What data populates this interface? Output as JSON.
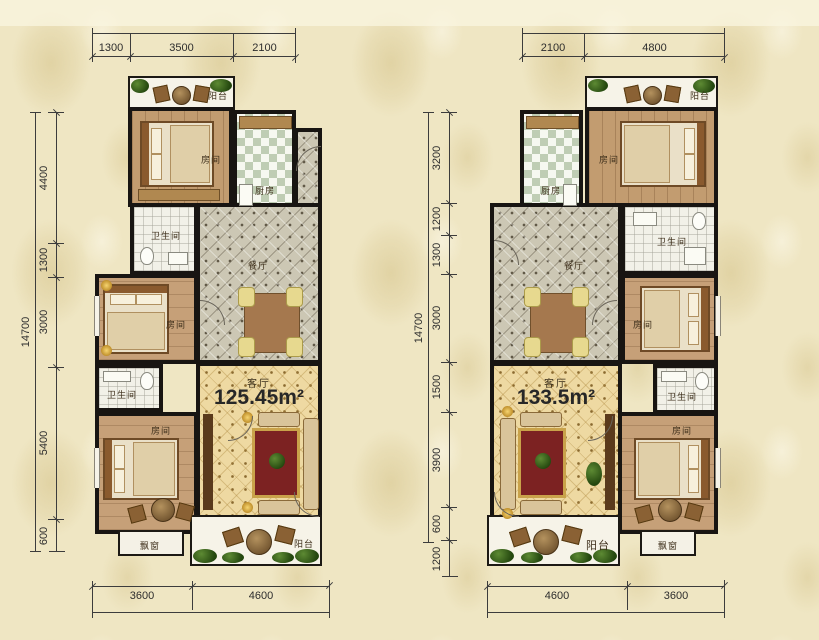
{
  "background": {
    "base": "#efe6c3",
    "pattern": "#e2d3a6"
  },
  "palette": {
    "wall": "#181512",
    "wood_floor": "#c29c70",
    "kitchen_tile": "#bfcdb4",
    "dining_tile": "#ccc7b4",
    "living_floor": "#eed9a2",
    "rug_red": "#7c2222",
    "accent_gold": "#c9a24a",
    "dimension_line": "#3c3c3c"
  },
  "labels": {
    "bedroom": "房间",
    "bathroom": "卫生间",
    "kitchen": "厨房",
    "dining": "餐厅",
    "living": "客厅",
    "balcony": "阳台",
    "bay_window": "飘窗"
  },
  "left_plan": {
    "area": "125.45m²",
    "dims": {
      "top": [
        "1300",
        "3500",
        "2100"
      ],
      "side_total": "14700",
      "side": [
        "4400",
        "1300",
        "3000",
        "5400",
        "600"
      ],
      "bottom": [
        "3600",
        "4600"
      ]
    }
  },
  "right_plan": {
    "area": "133.5m²",
    "dims": {
      "top": [
        "2100",
        "4800"
      ],
      "side_total": "14700",
      "side": [
        "3200",
        "1200",
        "1300",
        "3000",
        "1500",
        "3900",
        "600",
        "1200"
      ],
      "bottom": [
        "4600",
        "3600"
      ]
    }
  }
}
